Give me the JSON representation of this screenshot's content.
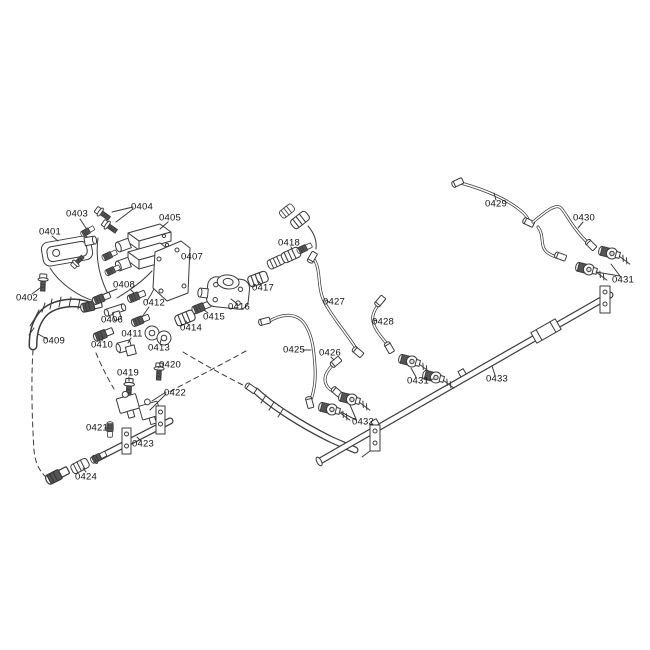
{
  "diagram": {
    "type": "exploded-parts-diagram",
    "background_color": "#ffffff",
    "line_color": "#3b3b3b",
    "label_color": "#111111",
    "labels": [
      {
        "part": "0401",
        "text": "0401",
        "x": 50,
        "y": 232
      },
      {
        "part": "0402",
        "text": "0402",
        "x": 27,
        "y": 298
      },
      {
        "part": "0403",
        "text": "0403",
        "x": 77,
        "y": 214
      },
      {
        "part": "0404",
        "text": "0404",
        "x": 142,
        "y": 207
      },
      {
        "part": "0405",
        "text": "0405",
        "x": 170,
        "y": 218
      },
      {
        "part": "0406",
        "text": "0406",
        "x": 112,
        "y": 320
      },
      {
        "part": "0407",
        "text": "0407",
        "x": 192,
        "y": 257
      },
      {
        "part": "0408",
        "text": "0408",
        "x": 124,
        "y": 285
      },
      {
        "part": "0409",
        "text": "0409",
        "x": 54,
        "y": 341
      },
      {
        "part": "0410",
        "text": "0410",
        "x": 102,
        "y": 345
      },
      {
        "part": "0411",
        "text": "0411",
        "x": 132,
        "y": 334
      },
      {
        "part": "0412",
        "text": "0412",
        "x": 154,
        "y": 303
      },
      {
        "part": "0413",
        "text": "0413",
        "x": 159,
        "y": 348
      },
      {
        "part": "0414",
        "text": "0414",
        "x": 191,
        "y": 328
      },
      {
        "part": "0415",
        "text": "0415",
        "x": 214,
        "y": 317
      },
      {
        "part": "0416",
        "text": "0416",
        "x": 239,
        "y": 307
      },
      {
        "part": "0417",
        "text": "0417",
        "x": 263,
        "y": 288
      },
      {
        "part": "0418",
        "text": "0418",
        "x": 289,
        "y": 243
      },
      {
        "part": "0419",
        "text": "0419",
        "x": 128,
        "y": 373
      },
      {
        "part": "0420",
        "text": "0420",
        "x": 170,
        "y": 365
      },
      {
        "part": "0421",
        "text": "0421",
        "x": 97,
        "y": 428
      },
      {
        "part": "0422",
        "text": "0422",
        "x": 175,
        "y": 393
      },
      {
        "part": "0423",
        "text": "0423",
        "x": 143,
        "y": 444
      },
      {
        "part": "0424",
        "text": "0424",
        "x": 86,
        "y": 477
      },
      {
        "part": "0425",
        "text": "0425",
        "x": 294,
        "y": 350
      },
      {
        "part": "0426",
        "text": "0426",
        "x": 330,
        "y": 353
      },
      {
        "part": "0427",
        "text": "0427",
        "x": 334,
        "y": 302
      },
      {
        "part": "0428",
        "text": "0428",
        "x": 383,
        "y": 322
      },
      {
        "part": "0429",
        "text": "0429",
        "x": 496,
        "y": 204
      },
      {
        "part": "0430",
        "text": "0430",
        "x": 584,
        "y": 218
      },
      {
        "part": "0431",
        "text": "0431",
        "x": 623,
        "y": 280
      },
      {
        "part": "0431",
        "text": "0431",
        "x": 418,
        "y": 381
      },
      {
        "part": "0432",
        "text": "0432",
        "x": 363,
        "y": 422
      },
      {
        "part": "0433",
        "text": "0433",
        "x": 497,
        "y": 379
      }
    ]
  }
}
